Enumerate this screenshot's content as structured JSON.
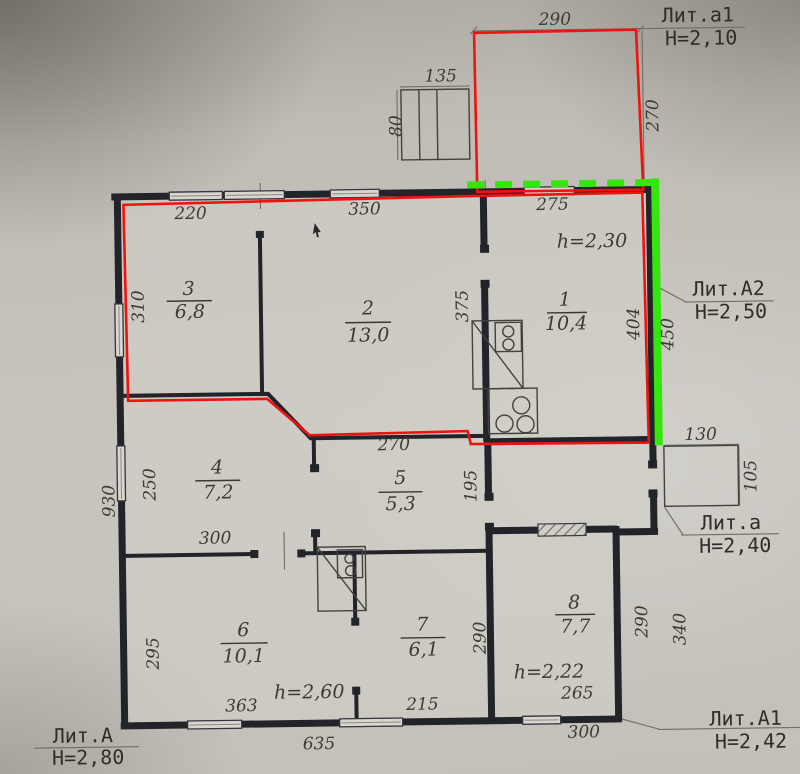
{
  "plan": {
    "liters": {
      "a1_top": {
        "name": "Лит.а1",
        "height": "Н=2,10"
      },
      "A2": {
        "name": "Лит.А2",
        "height": "Н=2,50"
      },
      "a_porch": {
        "name": "Лит.а",
        "height": "Н=2,40"
      },
      "A_main": {
        "name": "Лит.А",
        "height": "Н=2,80"
      },
      "A1": {
        "name": "Лит.А1",
        "height": "Н=2,42"
      }
    },
    "rooms": {
      "r1": {
        "num": "1",
        "area": "10,4",
        "height": "h=2,30"
      },
      "r2": {
        "num": "2",
        "area": "13,0"
      },
      "r3": {
        "num": "3",
        "area": "6,8"
      },
      "r4": {
        "num": "4",
        "area": "7,2"
      },
      "r5": {
        "num": "5",
        "area": "5,3"
      },
      "r6": {
        "num": "6",
        "area": "10,1",
        "height": "h=2,60"
      },
      "r7": {
        "num": "7",
        "area": "6,1"
      },
      "r8": {
        "num": "8",
        "area": "7,7",
        "height": "h=2,22"
      }
    },
    "dims": {
      "annex_top_width": "290",
      "annex_top_height": "270",
      "steps_width": "135",
      "steps_height": "80",
      "r3_top": "220",
      "r2_top": "350",
      "r1_top": "275",
      "r3_left": "310",
      "r1_wall": "375",
      "r1_right_inner": "404",
      "r1_right_outer": "450",
      "r5_top": "270",
      "r4_left": "250",
      "left_total": "930",
      "hall_right": "195",
      "porch_width": "130",
      "porch_height": "105",
      "r4_bottom": "300",
      "r6_top": "300",
      "r6_left": "295",
      "r7_wall": "290",
      "r8_right_inner": "290",
      "r8_right_outer": "340",
      "r8_bottom_inner": "265",
      "r8_bottom_outer": "300",
      "r6_bottom": "363",
      "r7_bottom": "215",
      "bottom_total": "635"
    },
    "colors": {
      "red_outline": "#ef1310",
      "green_outline": "#35e60e",
      "wall": "#23232a",
      "paper": "#c0bdb6"
    }
  }
}
